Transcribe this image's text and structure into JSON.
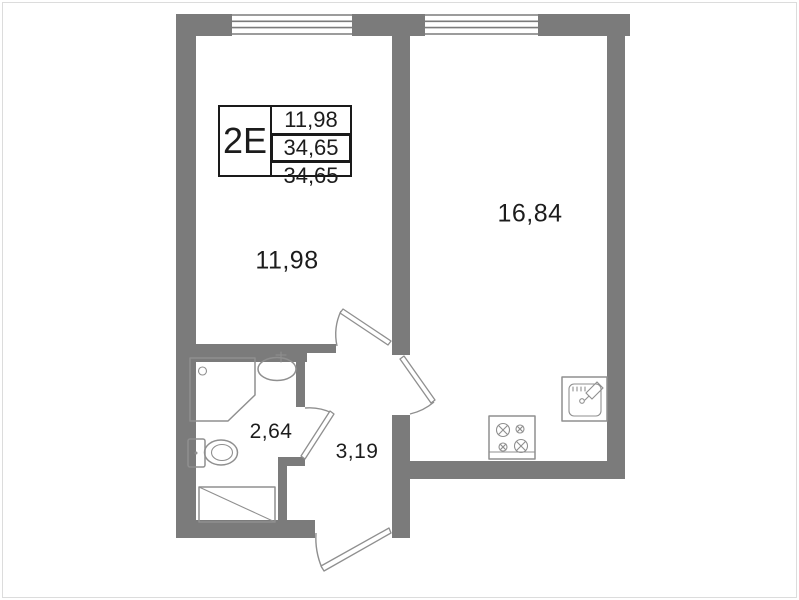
{
  "colors": {
    "wall": "#7b7b7b",
    "fixline": "#8f8f8f",
    "text": "#1c1c1c",
    "tbborder": "#1a1a1a",
    "frame": "#dcdcdc",
    "bg": "#ffffff"
  },
  "title_block": {
    "unit_code": "2Е",
    "rows": [
      "11,98",
      "34,65",
      "34,65"
    ]
  },
  "rooms": [
    {
      "id": "room-left",
      "area": "11,98"
    },
    {
      "id": "room-right",
      "area": "16,84"
    },
    {
      "id": "bathroom",
      "area": "2,64"
    },
    {
      "id": "hall",
      "area": "3,19"
    }
  ],
  "fixtures": [
    "shower-cabin",
    "washbasin",
    "toilet",
    "appliance-niche",
    "stove",
    "kitchen-sink"
  ]
}
